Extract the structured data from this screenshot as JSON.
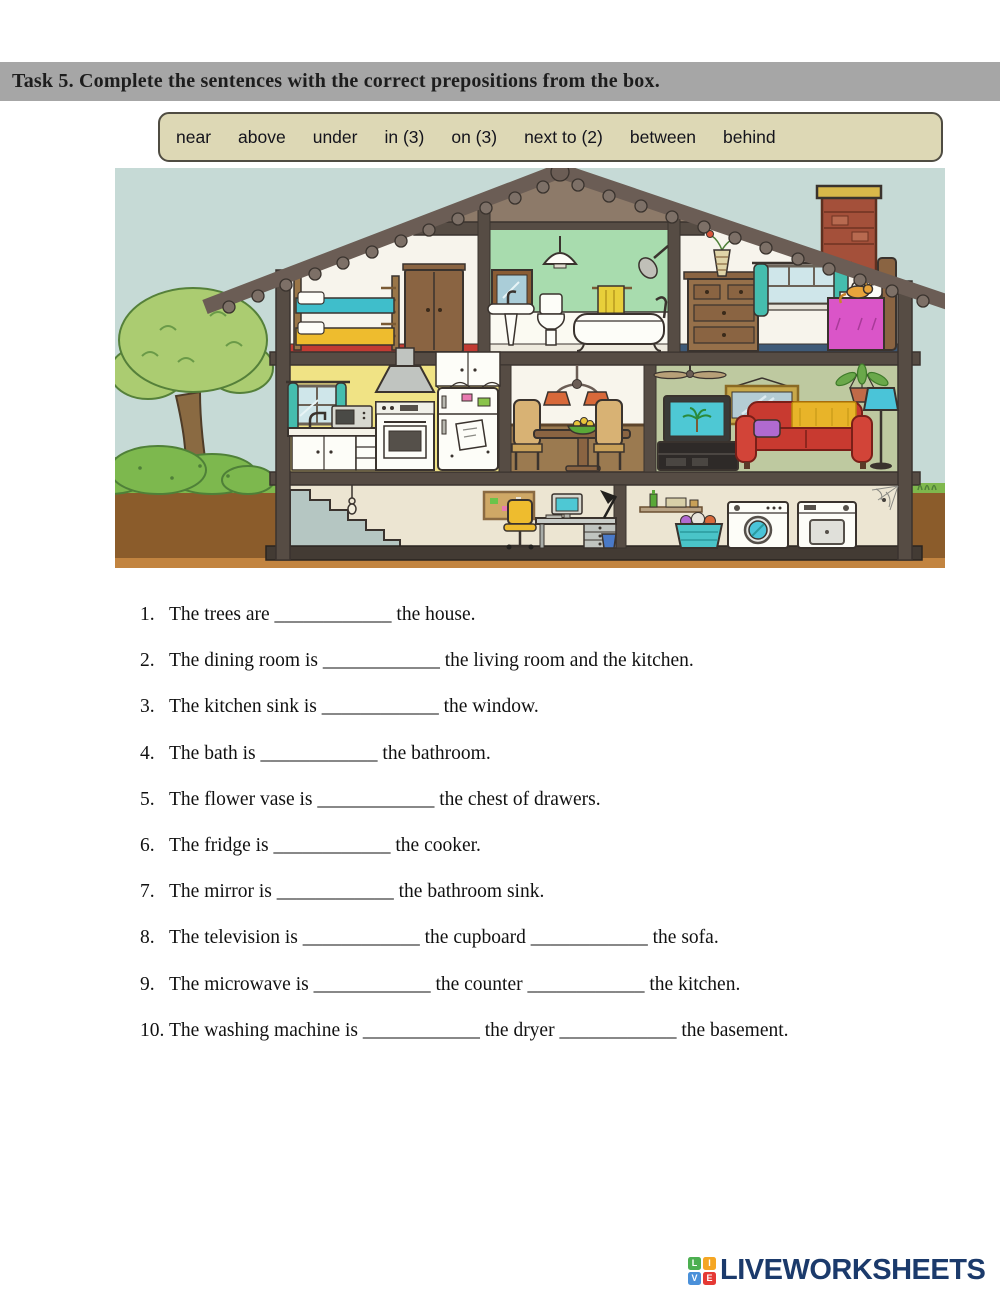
{
  "task_header": {
    "text": "Task 5. Complete the sentences with the correct prepositions from the box.",
    "background": "#a6a6a6"
  },
  "word_box": {
    "background": "#ddd8b5",
    "items": [
      "near",
      "above",
      "under",
      "in (3)",
      "on (3)",
      "next to (2)",
      "between",
      "behind"
    ]
  },
  "sentences": [
    {
      "number": "1.",
      "text": "The trees are ____________ the house."
    },
    {
      "number": "2.",
      "text": "The dining room is ____________ the living room and the kitchen."
    },
    {
      "number": "3.",
      "text": "The kitchen sink is ____________ the window."
    },
    {
      "number": "4.",
      "text": "The bath is ____________ the bathroom."
    },
    {
      "number": "5.",
      "text": "The flower vase is ____________ the chest of drawers."
    },
    {
      "number": "6.",
      "text": "The fridge is ____________ the cooker."
    },
    {
      "number": "7.",
      "text": "The mirror is ____________ the bathroom sink."
    },
    {
      "number": "8.",
      "text": "The television is ____________ the cupboard ____________ the sofa."
    },
    {
      "number": "9.",
      "text": "The microwave is ____________ the counter ____________ the kitchen."
    },
    {
      "number": "10.",
      "text": "The washing machine is ____________ the dryer ____________ the basement."
    }
  ],
  "footer_logo": {
    "text": "LIVEWORKSHEETS",
    "text_color": "#1b3a6b",
    "tiles": [
      {
        "letter": "L",
        "color": "#4caf50"
      },
      {
        "letter": "I",
        "color": "#f5a623"
      },
      {
        "letter": "V",
        "color": "#4a90d9"
      },
      {
        "letter": "E",
        "color": "#e53935"
      }
    ]
  }
}
